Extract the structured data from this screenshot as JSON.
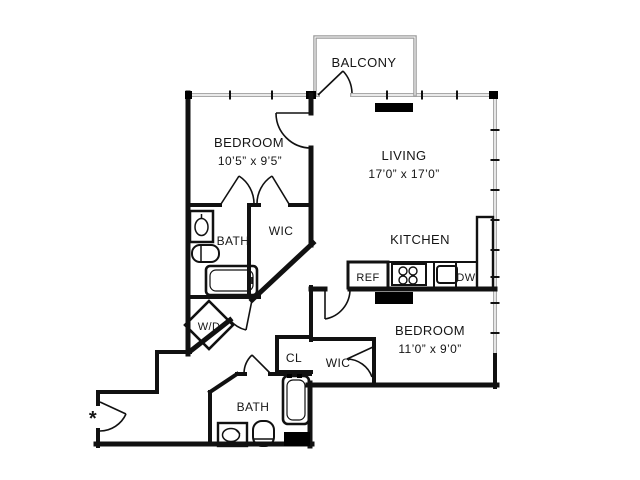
{
  "plan": {
    "type": "apartment-floor-plan",
    "colors": {
      "wall": "#111111",
      "window_wall": "#a9a9a9",
      "balcony_wall": "#9a9a9a",
      "background": "#ffffff"
    },
    "rooms": {
      "balcony": {
        "label": "BALCONY"
      },
      "bedroom1": {
        "label": "BEDROOM",
        "dims": "10’5” x 9’5”"
      },
      "living": {
        "label": "LIVING",
        "dims": "17’0” x 17’0”"
      },
      "kitchen": {
        "label": "KITCHEN"
      },
      "bedroom2": {
        "label": "BEDROOM",
        "dims": "11’0” x 9’0”"
      },
      "bath1": {
        "label": "BATH"
      },
      "bath2": {
        "label": "BATH"
      },
      "wic1": {
        "label": "WIC"
      },
      "wic2": {
        "label": "WIC"
      },
      "closet": {
        "label": "CL"
      },
      "laundry": {
        "label": "W/D"
      }
    },
    "appliances": {
      "refrigerator": "REF",
      "dishwasher": "DW"
    },
    "annotation": {
      "entry_marker": "*"
    }
  }
}
